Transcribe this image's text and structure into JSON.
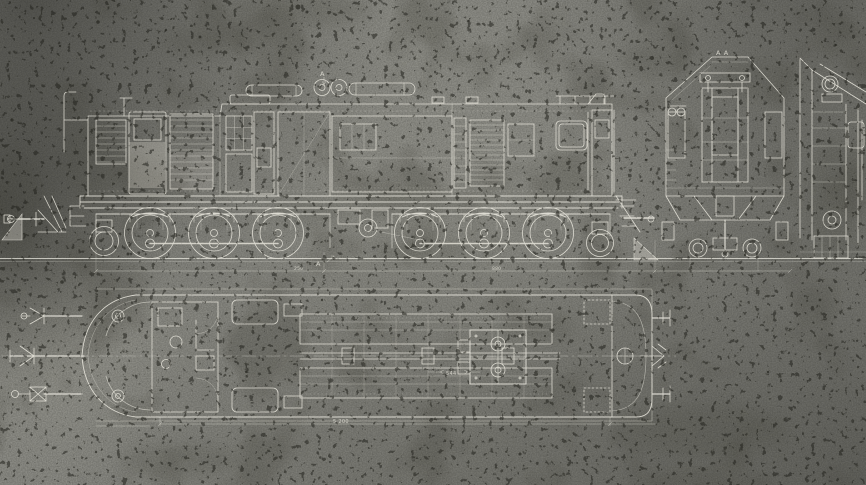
{
  "colors": {
    "background": "#8b8b85",
    "line": "#eae8de",
    "speck": "#23231d",
    "stain": "#4e4d45"
  },
  "annotations": {
    "section_label_end_view": "A A",
    "section_marker_top": "A",
    "section_marker_bottom": "A",
    "dim_bogie_left": "250",
    "dim_bogie_right": "880",
    "dim_plan_inner": "544",
    "dim_plan_overall": "5,200"
  }
}
